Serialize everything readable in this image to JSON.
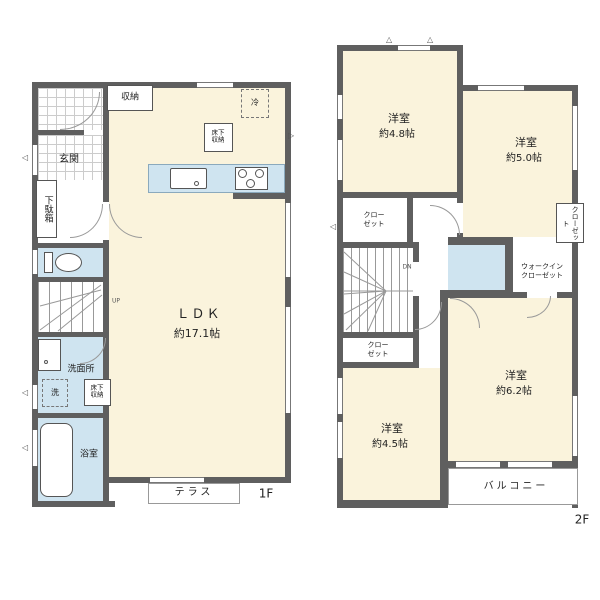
{
  "colors": {
    "wall": "#5f5f5f",
    "floor_cream": "#faf3dc",
    "floor_wet": "#cfe4f0"
  },
  "floor1": {
    "label": "1F",
    "entrance": "玄関",
    "shoe_cabinet": "下駄箱",
    "storage": "収納",
    "fridge": "冷",
    "underfloor_storage_kitchen": "床下\n収納",
    "ldk": "ＬＤＫ",
    "ldk_size": "約17.1帖",
    "up": "UP",
    "washroom": "洗面所",
    "washer": "洗",
    "underfloor_storage_washroom": "床下\n収納",
    "bathroom": "浴室",
    "terrace": "テラス"
  },
  "floor2": {
    "label": "2F",
    "room_a": "洋室",
    "room_a_size": "約4.8帖",
    "room_b": "洋室",
    "room_b_size": "約5.0帖",
    "room_c": "洋室",
    "room_c_size": "約6.2帖",
    "room_d": "洋室",
    "room_d_size": "約4.5帖",
    "closet_a": "クロー\nゼット",
    "closet_b": "クロー\nゼット",
    "closet_side": "クローゼット",
    "walk_in_closet": "ウォークイン\nクローゼット",
    "balcony": "バルコニー",
    "dn": "DN"
  }
}
